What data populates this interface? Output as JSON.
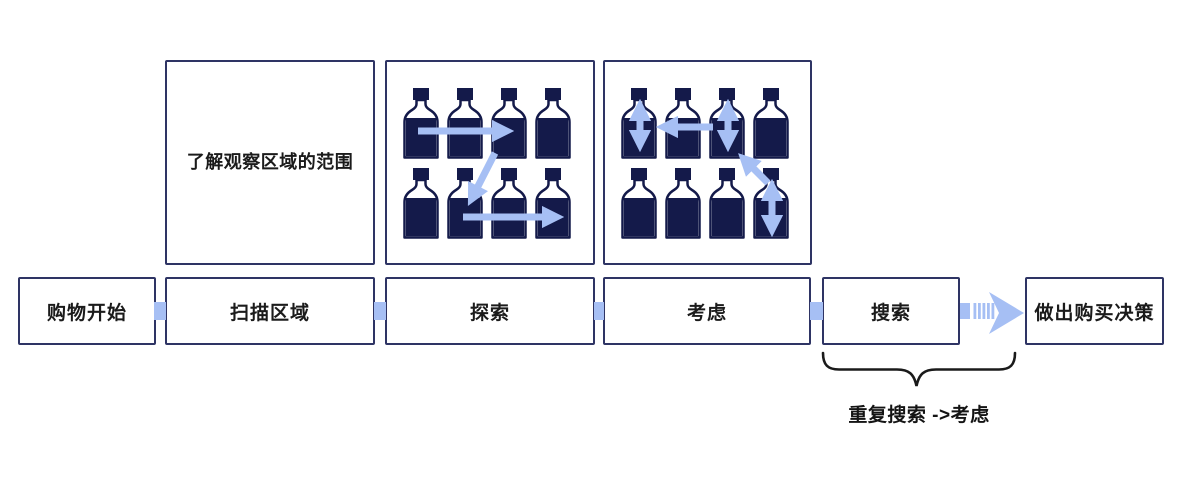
{
  "diagram": {
    "title_hint": "shopping decision journey flow",
    "colors": {
      "background": "#ffffff",
      "navy": "#141a4a",
      "box_border": "#2e3464",
      "light_blue": "#a6bff4",
      "text": "#1b1b1b"
    },
    "steps": [
      {
        "label": "购物开始"
      },
      {
        "label": "扫描区域"
      },
      {
        "label": "探索"
      },
      {
        "label": "考虑"
      },
      {
        "label": "搜索"
      },
      {
        "label": "做出购买决策"
      }
    ],
    "annotations": {
      "scan_note": "了解观察区域的范围",
      "repeat_loop": "重复搜索 ->考虑"
    },
    "icons": [
      {
        "name": "explore-bottles-icon"
      },
      {
        "name": "consider-bottles-icon"
      },
      {
        "name": "striped-chevron-arrow-icon"
      },
      {
        "name": "curly-brace"
      }
    ]
  }
}
